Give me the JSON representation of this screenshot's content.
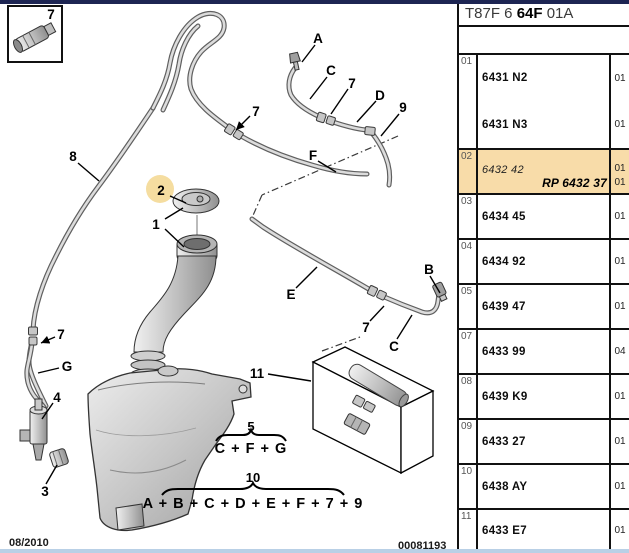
{
  "header": {
    "code": [
      "T87F 6 ",
      "64F",
      " 01A"
    ]
  },
  "table": {
    "rows": [
      {
        "ref": "01",
        "highlight": false,
        "parts": [
          {
            "label": "6431 N2",
            "qty": "01"
          },
          {
            "label": "6431 N3",
            "qty": "01"
          }
        ]
      },
      {
        "ref": "02",
        "highlight": true,
        "parts": [
          {
            "label": "6432 42",
            "qty": "01"
          },
          {
            "label": "RP 6432 37",
            "qty": "01"
          }
        ]
      },
      {
        "ref": "03",
        "highlight": false,
        "parts": [
          {
            "label": "6434 45",
            "qty": "01"
          }
        ]
      },
      {
        "ref": "04",
        "highlight": false,
        "parts": [
          {
            "label": "6434 92",
            "qty": "01"
          }
        ]
      },
      {
        "ref": "05",
        "highlight": false,
        "parts": [
          {
            "label": "6439 47",
            "qty": "01"
          }
        ]
      },
      {
        "ref": "07",
        "highlight": false,
        "parts": [
          {
            "label": "6433 99",
            "qty": "04"
          }
        ]
      },
      {
        "ref": "08",
        "highlight": false,
        "parts": [
          {
            "label": "6439 K9",
            "qty": "01"
          }
        ]
      },
      {
        "ref": "09",
        "highlight": false,
        "parts": [
          {
            "label": "6433 27",
            "qty": "01"
          }
        ]
      },
      {
        "ref": "10",
        "highlight": false,
        "parts": [
          {
            "label": "6438 AY",
            "qty": "01"
          }
        ]
      },
      {
        "ref": "11",
        "highlight": false,
        "parts": [
          {
            "label": "6433 E7",
            "qty": "01"
          }
        ]
      }
    ]
  },
  "diagram": {
    "callouts": [
      "A",
      "C",
      "7",
      "D",
      "9",
      "F",
      "8",
      "7",
      "2",
      "1",
      "E",
      "B",
      "7",
      "C",
      "7",
      "G",
      "4",
      "3",
      "11",
      "7"
    ],
    "highlight_circle_color": "#F5DDA0"
  },
  "formulas": {
    "five": {
      "number": "5",
      "expr": "C + F + G"
    },
    "ten": {
      "number": "10",
      "expr": "A + B + C + D + E + F + 7 + 9"
    }
  },
  "footer": {
    "date": "08/2010",
    "doc_number": "00081193"
  },
  "colors": {
    "highlight_row": "#F8DCA9",
    "top_bar": "#1d2553",
    "bottom_bar": "#b9d0e6"
  }
}
